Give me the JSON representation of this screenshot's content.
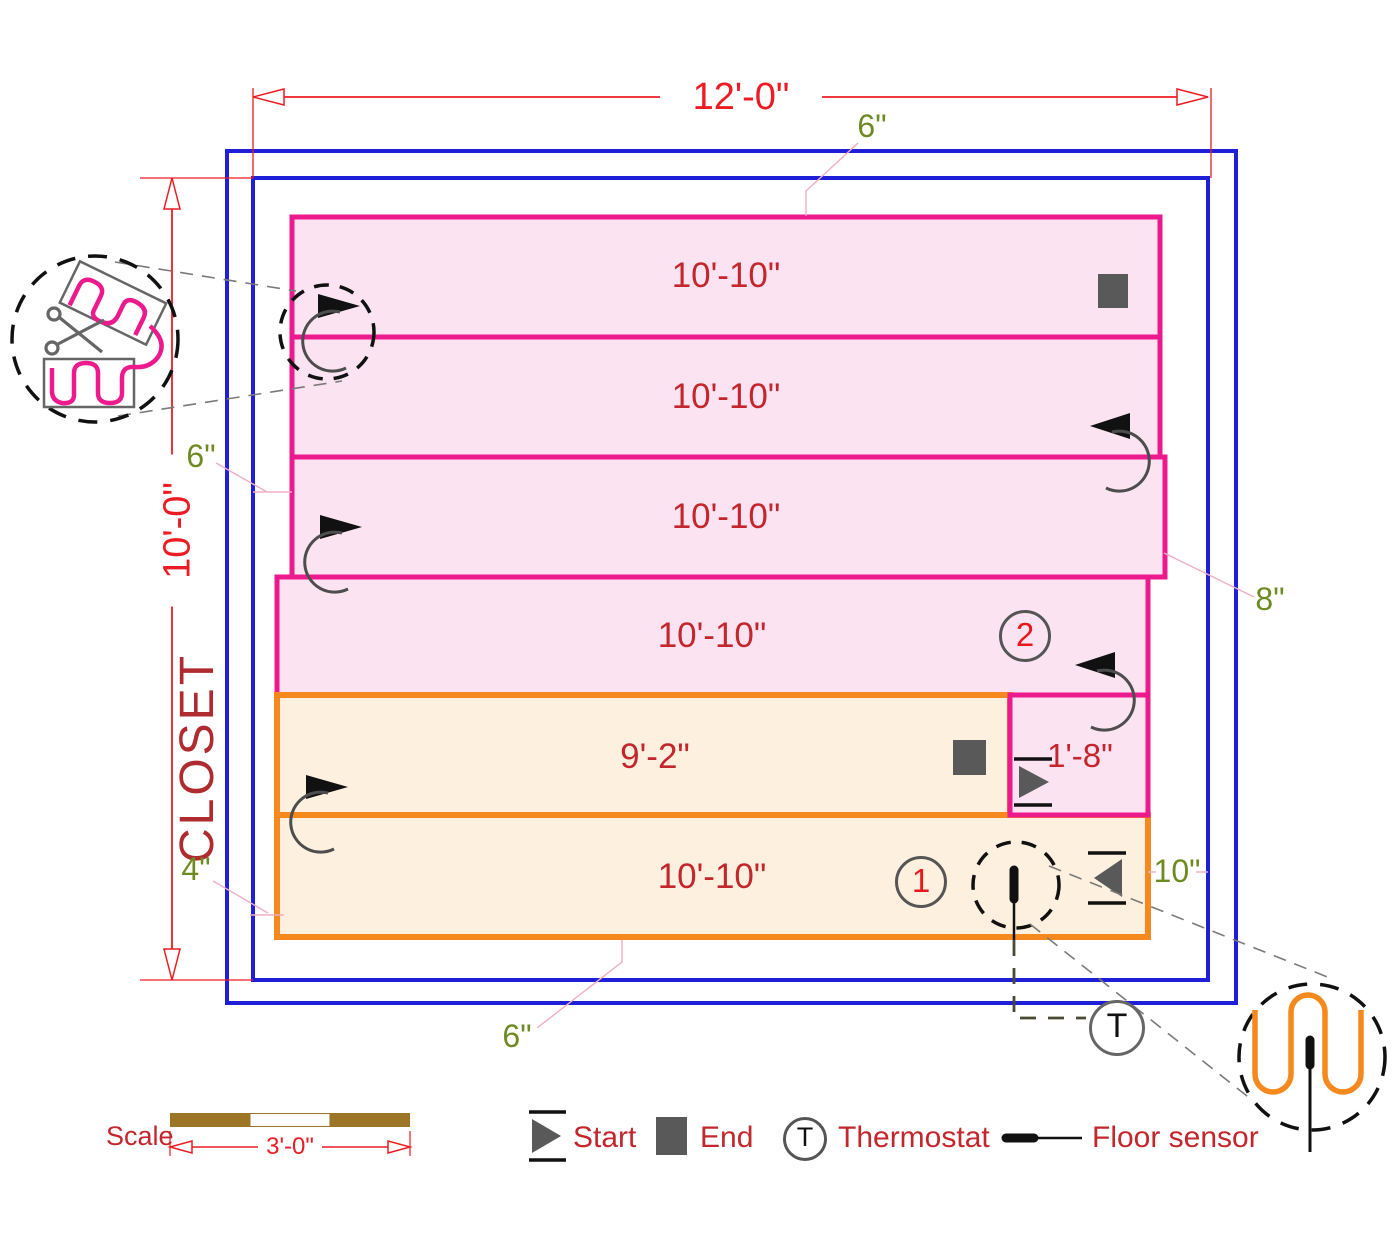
{
  "room": {
    "label": "CLOSET"
  },
  "dimensions": {
    "width": "12'-0\"",
    "height": "10'-0\""
  },
  "clearances": {
    "top": "6\"",
    "left": "6\"",
    "bottom_left": "4\"",
    "right": "8\"",
    "sensor_right": "10\"",
    "bottom": "6\""
  },
  "mats": {
    "rows": [
      "10'-10\"",
      "10'-10\"",
      "10'-10\"",
      "10'-10\"",
      "9'-2\"",
      "10'-10\""
    ],
    "small_mat": "1'-8\""
  },
  "zones": [
    {
      "number": "1"
    },
    {
      "number": "2"
    }
  ],
  "thermostat": {
    "symbol": "T"
  },
  "legend": {
    "scale_label": "Scale",
    "scale_dim": "3'-0\"",
    "start": "Start",
    "end": "End",
    "thermostat": "Thermostat",
    "floor_sensor": "Floor sensor"
  },
  "colors": {
    "wall_blue": "#1F1FD8",
    "mat_pink_border": "#EC1A8C",
    "mat_pink_fill": "#FBE3F2",
    "mat_orange_border": "#F5891D",
    "mat_orange_fill": "#FDF0DE",
    "dimension_red": "#EC1C24",
    "label_crimson": "#C3262C",
    "note_green": "#6E8B22",
    "scale_brown": "#9C7626",
    "symbol_gray": "#595959"
  }
}
